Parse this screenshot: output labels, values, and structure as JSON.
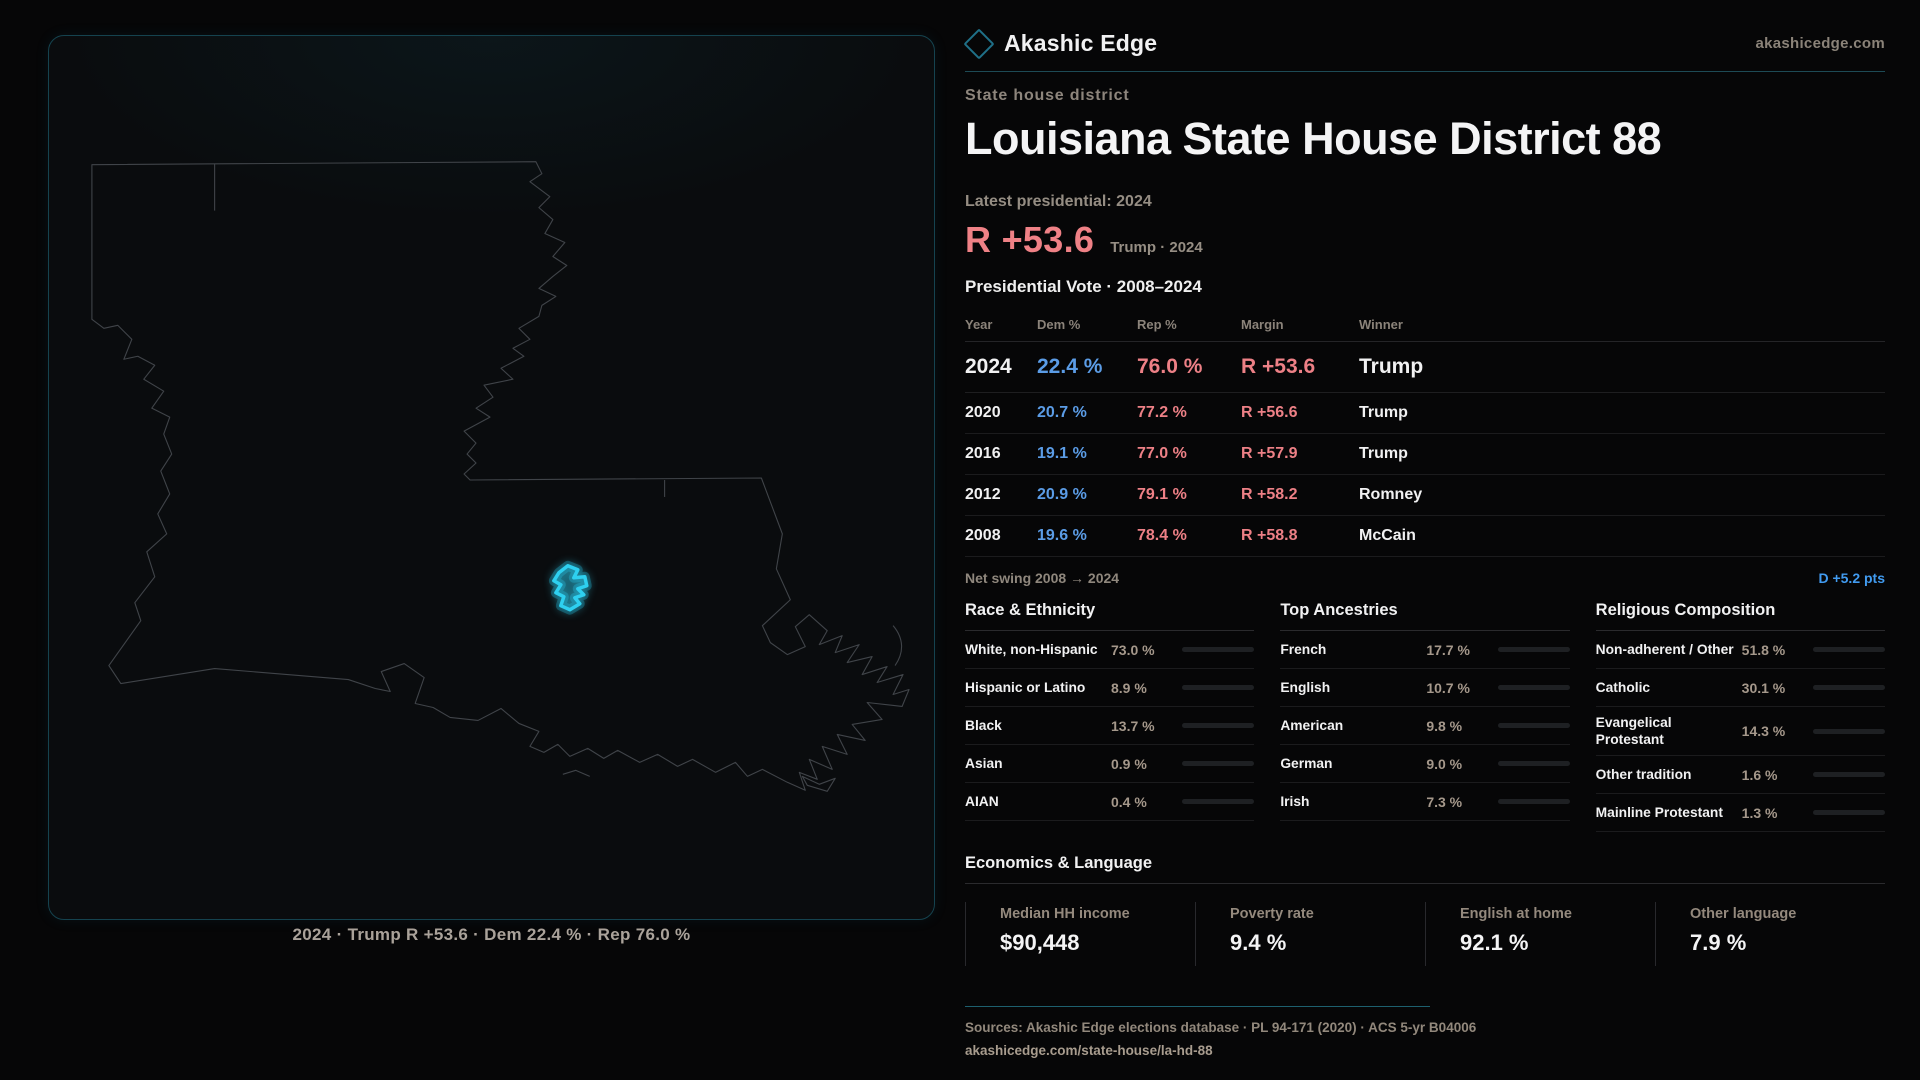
{
  "brand": {
    "name": "Akashic Edge",
    "site": "akashicedge.com",
    "accent_teal": "#2ed0f0"
  },
  "map": {
    "caption": "2024 · Trump R +53.6 · Dem 22.4 % · Rep 76.0 %",
    "state": "Louisiana",
    "highlight_color": "#2ed0f0"
  },
  "header": {
    "kicker": "State house district",
    "title": "Louisiana State House District 88",
    "latest_label": "Latest presidential: 2024",
    "margin_value": "R +53.6",
    "margin_context": "Trump · 2024"
  },
  "table": {
    "title": "Presidential Vote · 2008–2024",
    "columns": {
      "year": "Year",
      "dem": "Dem %",
      "rep": "Rep %",
      "margin": "Margin",
      "winner": "Winner"
    },
    "rows": [
      {
        "year": "2024",
        "dem": "22.4 %",
        "rep": "76.0 %",
        "margin": "R +53.6",
        "winner": "Trump"
      },
      {
        "year": "2020",
        "dem": "20.7 %",
        "rep": "77.2 %",
        "margin": "R +56.6",
        "winner": "Trump"
      },
      {
        "year": "2016",
        "dem": "19.1 %",
        "rep": "77.0 %",
        "margin": "R +57.9",
        "winner": "Trump"
      },
      {
        "year": "2012",
        "dem": "20.9 %",
        "rep": "79.1 %",
        "margin": "R +58.2",
        "winner": "Romney"
      },
      {
        "year": "2008",
        "dem": "19.6 %",
        "rep": "78.4 %",
        "margin": "R +58.8",
        "winner": "McCain"
      }
    ],
    "net_swing_label": "Net swing 2008 → 2024",
    "net_swing_value": "D +5.2 pts",
    "dem_color": "#5b9ce6",
    "rep_color": "#ed8086",
    "swing_color": "#419bf0"
  },
  "demographics": {
    "race": {
      "title": "Race & Ethnicity",
      "items": [
        {
          "label": "White, non-Hispanic",
          "value": "73.0 %",
          "pct": 73.0,
          "color": "#9bacc6"
        },
        {
          "label": "Hispanic or Latino",
          "value": "8.9 %",
          "pct": 8.9,
          "color": "#e8a33d"
        },
        {
          "label": "Black",
          "value": "13.7 %",
          "pct": 13.7,
          "color": "#9383ee"
        },
        {
          "label": "Asian",
          "value": "0.9 %",
          "pct": 0.9,
          "color": "#35c08b"
        },
        {
          "label": "AIAN",
          "value": "0.4 %",
          "pct": 0.4,
          "color": "#8a8f99"
        }
      ]
    },
    "ancestries": {
      "title": "Top Ancestries",
      "items": [
        {
          "label": "French",
          "value": "17.7 %",
          "pct": 17.7,
          "color": "#8fa6c2"
        },
        {
          "label": "English",
          "value": "10.7 %",
          "pct": 10.7,
          "color": "#8fa6c2"
        },
        {
          "label": "American",
          "value": "9.8 %",
          "pct": 9.8,
          "color": "#8fa6c2"
        },
        {
          "label": "German",
          "value": "9.0 %",
          "pct": 9.0,
          "color": "#8fa6c2"
        },
        {
          "label": "Irish",
          "value": "7.3 %",
          "pct": 7.3,
          "color": "#8fa6c2"
        }
      ]
    },
    "religion": {
      "title": "Religious Composition",
      "items": [
        {
          "label": "Non-adherent / Other",
          "value": "51.8 %",
          "pct": 51.8,
          "color": "#8894ab"
        },
        {
          "label": "Catholic",
          "value": "30.1 %",
          "pct": 30.1,
          "color": "#e6c33a"
        },
        {
          "label": "Evangelical Protestant",
          "value": "14.3 %",
          "pct": 14.3,
          "color": "#e57070"
        },
        {
          "label": "Other tradition",
          "value": "1.6 %",
          "pct": 1.6,
          "color": "#dcdcdc"
        },
        {
          "label": "Mainline Protestant",
          "value": "1.3 %",
          "pct": 1.3,
          "color": "#4a90e0"
        }
      ]
    }
  },
  "economics": {
    "title": "Economics & Language",
    "stats": [
      {
        "label": "Median HH income",
        "value": "$90,448"
      },
      {
        "label": "Poverty rate",
        "value": "9.4 %"
      },
      {
        "label": "English at home",
        "value": "92.1 %"
      },
      {
        "label": "Other language",
        "value": "7.9 %"
      }
    ]
  },
  "footer": {
    "sources": "Sources: Akashic Edge elections database · PL 94-171 (2020) · ACS 5-yr B04006",
    "url": "akashicedge.com/state-house/la-hd-88"
  }
}
